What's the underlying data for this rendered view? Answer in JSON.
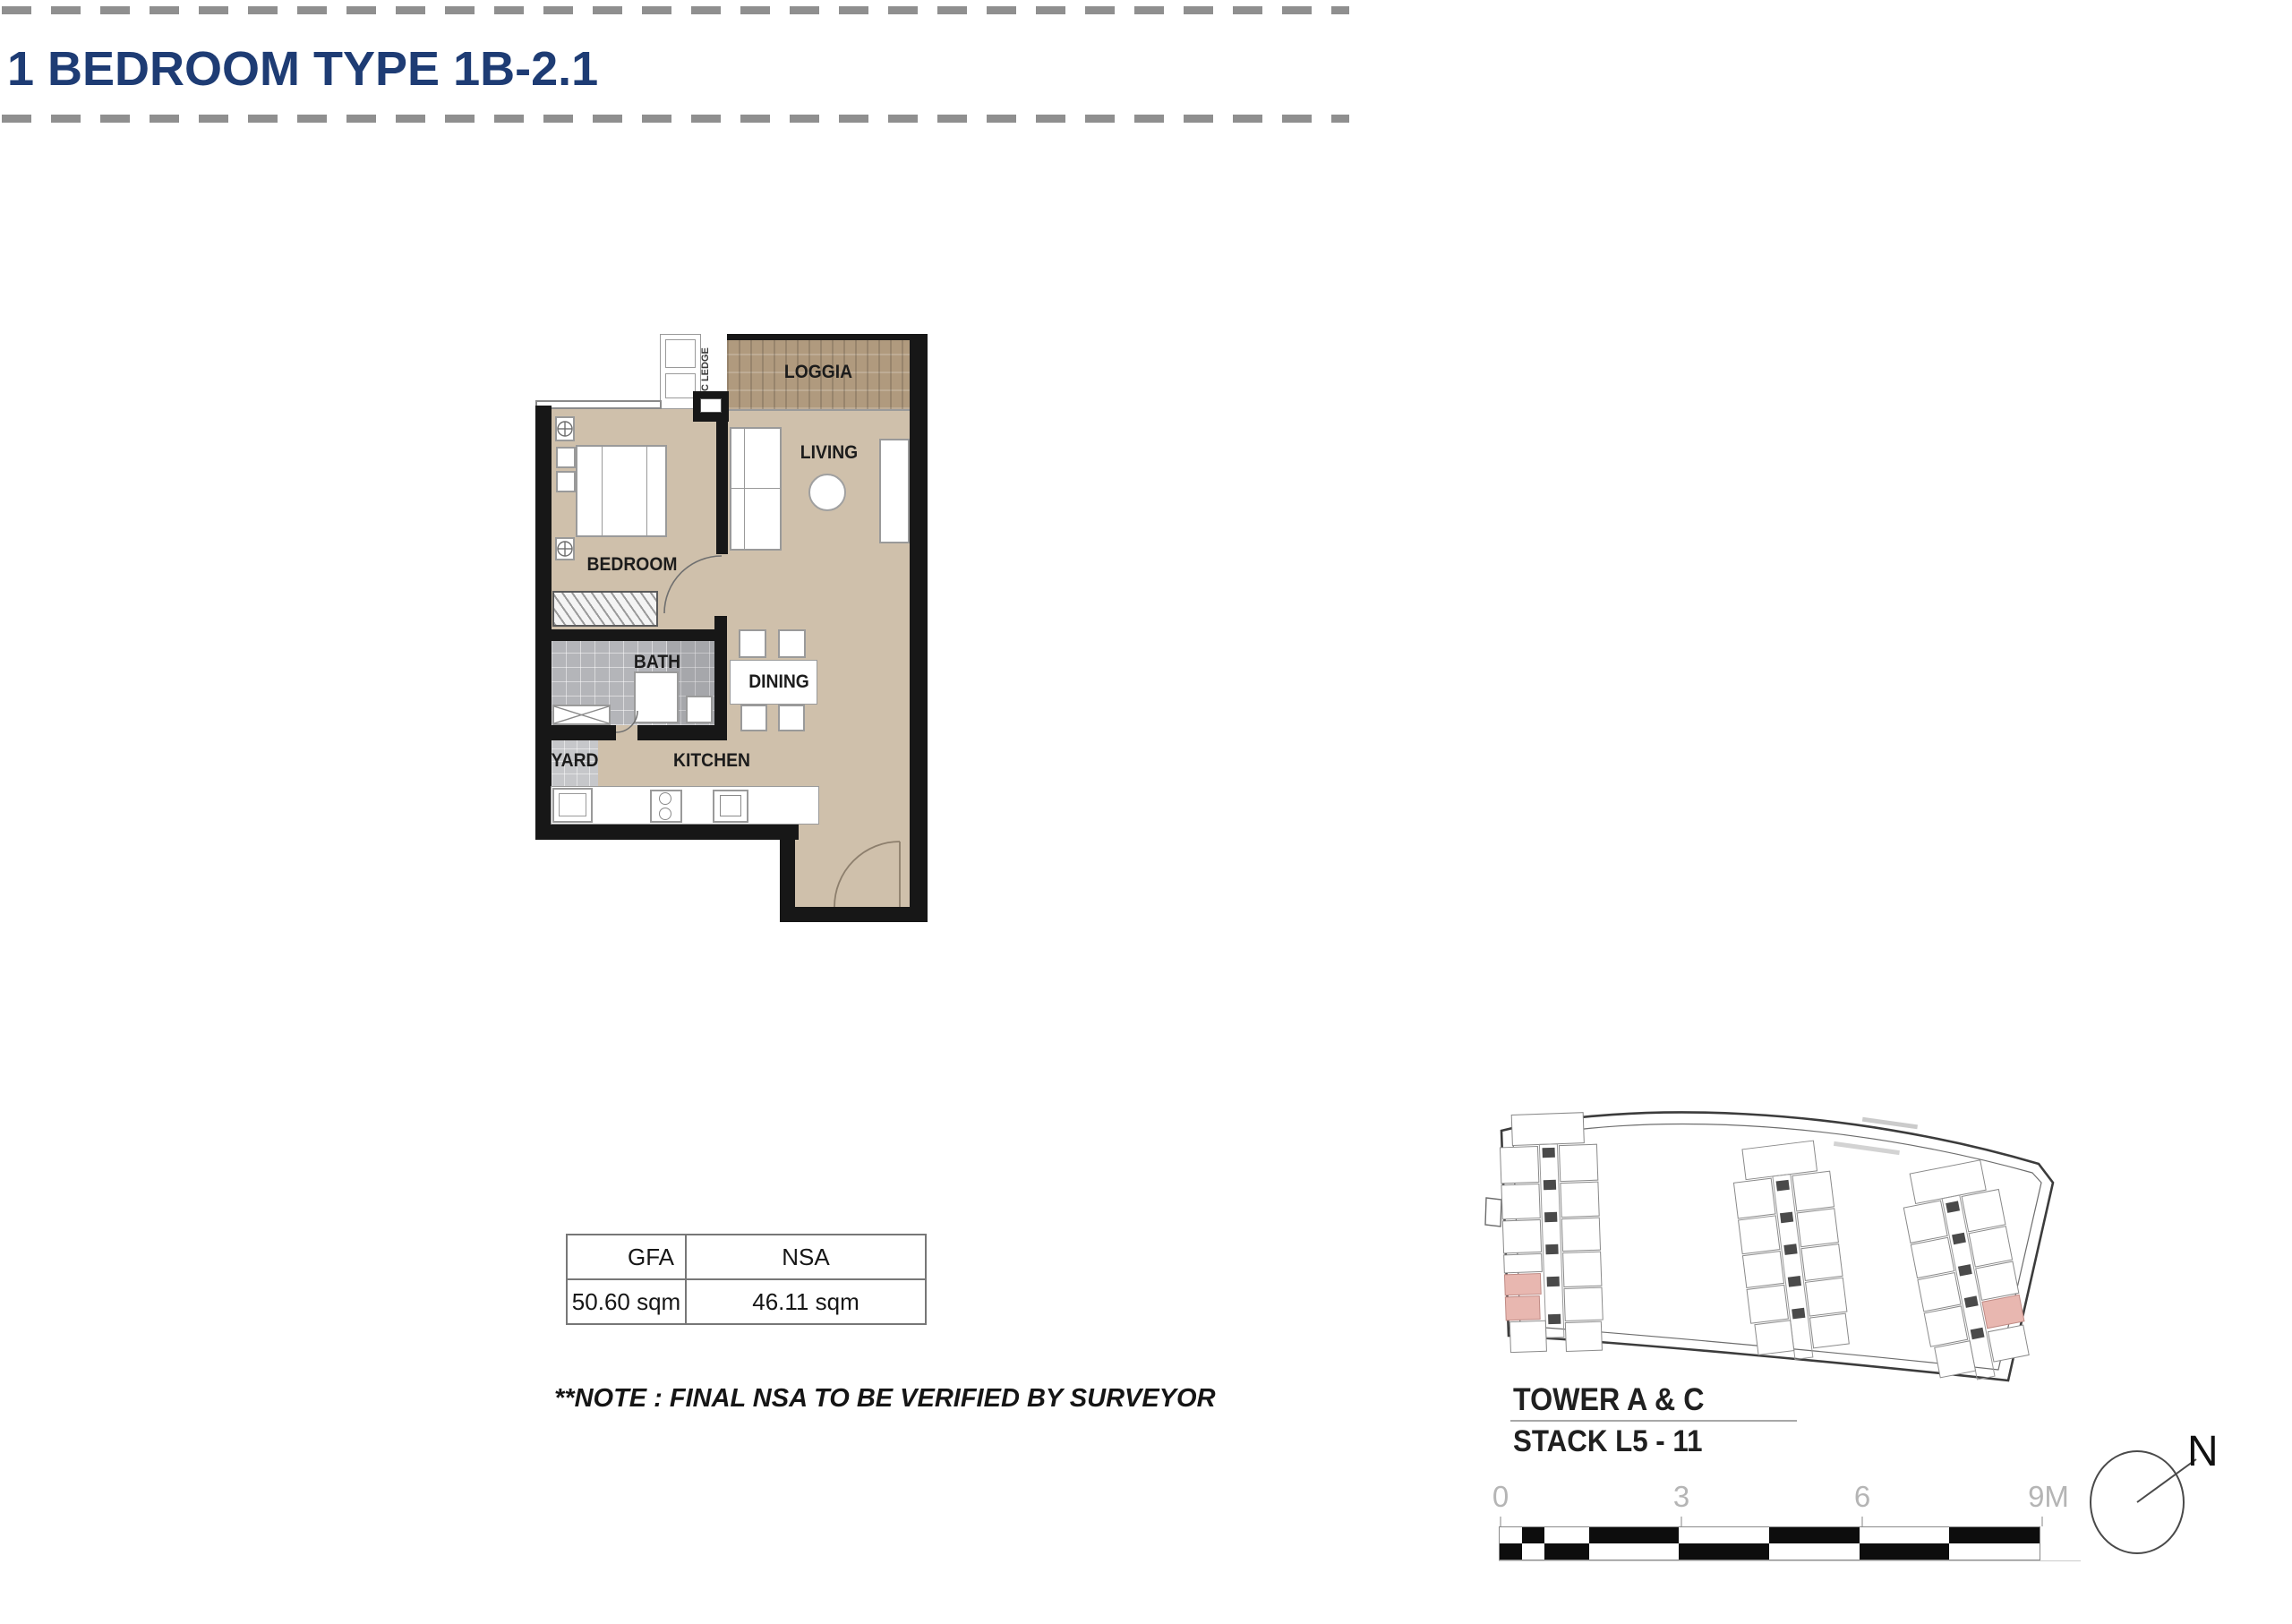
{
  "page": {
    "title": "1 BEDROOM TYPE 1B-2.1"
  },
  "floor_plan": {
    "labels": {
      "loggia": "LOGGIA",
      "living": "LIVING",
      "bedroom": "BEDROOM",
      "bath": "BATH",
      "dining": "DINING",
      "yard": "YARD",
      "kitchen": "KITCHEN",
      "ac_ledge": "AC LEDGE"
    }
  },
  "area_table": {
    "gfa_label": "GFA",
    "nsa_label": "NSA",
    "gfa_value": "50.60 sqm",
    "nsa_value": "46.11 sqm"
  },
  "note": "**NOTE : FINAL NSA TO BE VERIFIED BY SURVEYOR",
  "site_plan": {
    "tower_label": "TOWER A & C",
    "stack_label": "STACK L5 - 11",
    "scale_labels": [
      "0",
      "3",
      "6",
      "9M"
    ],
    "north_label": "N",
    "highlight_color": "#e8b7b0"
  },
  "colors": {
    "title": "#1e3c74",
    "wall": "#171717",
    "floor": "#cfc0ab",
    "loggia_wood": "#b09a7e",
    "bath_tile": "#b4b5b9",
    "unit_highlight": "#e8b7b0",
    "scale_text": "#b5b5b5"
  }
}
